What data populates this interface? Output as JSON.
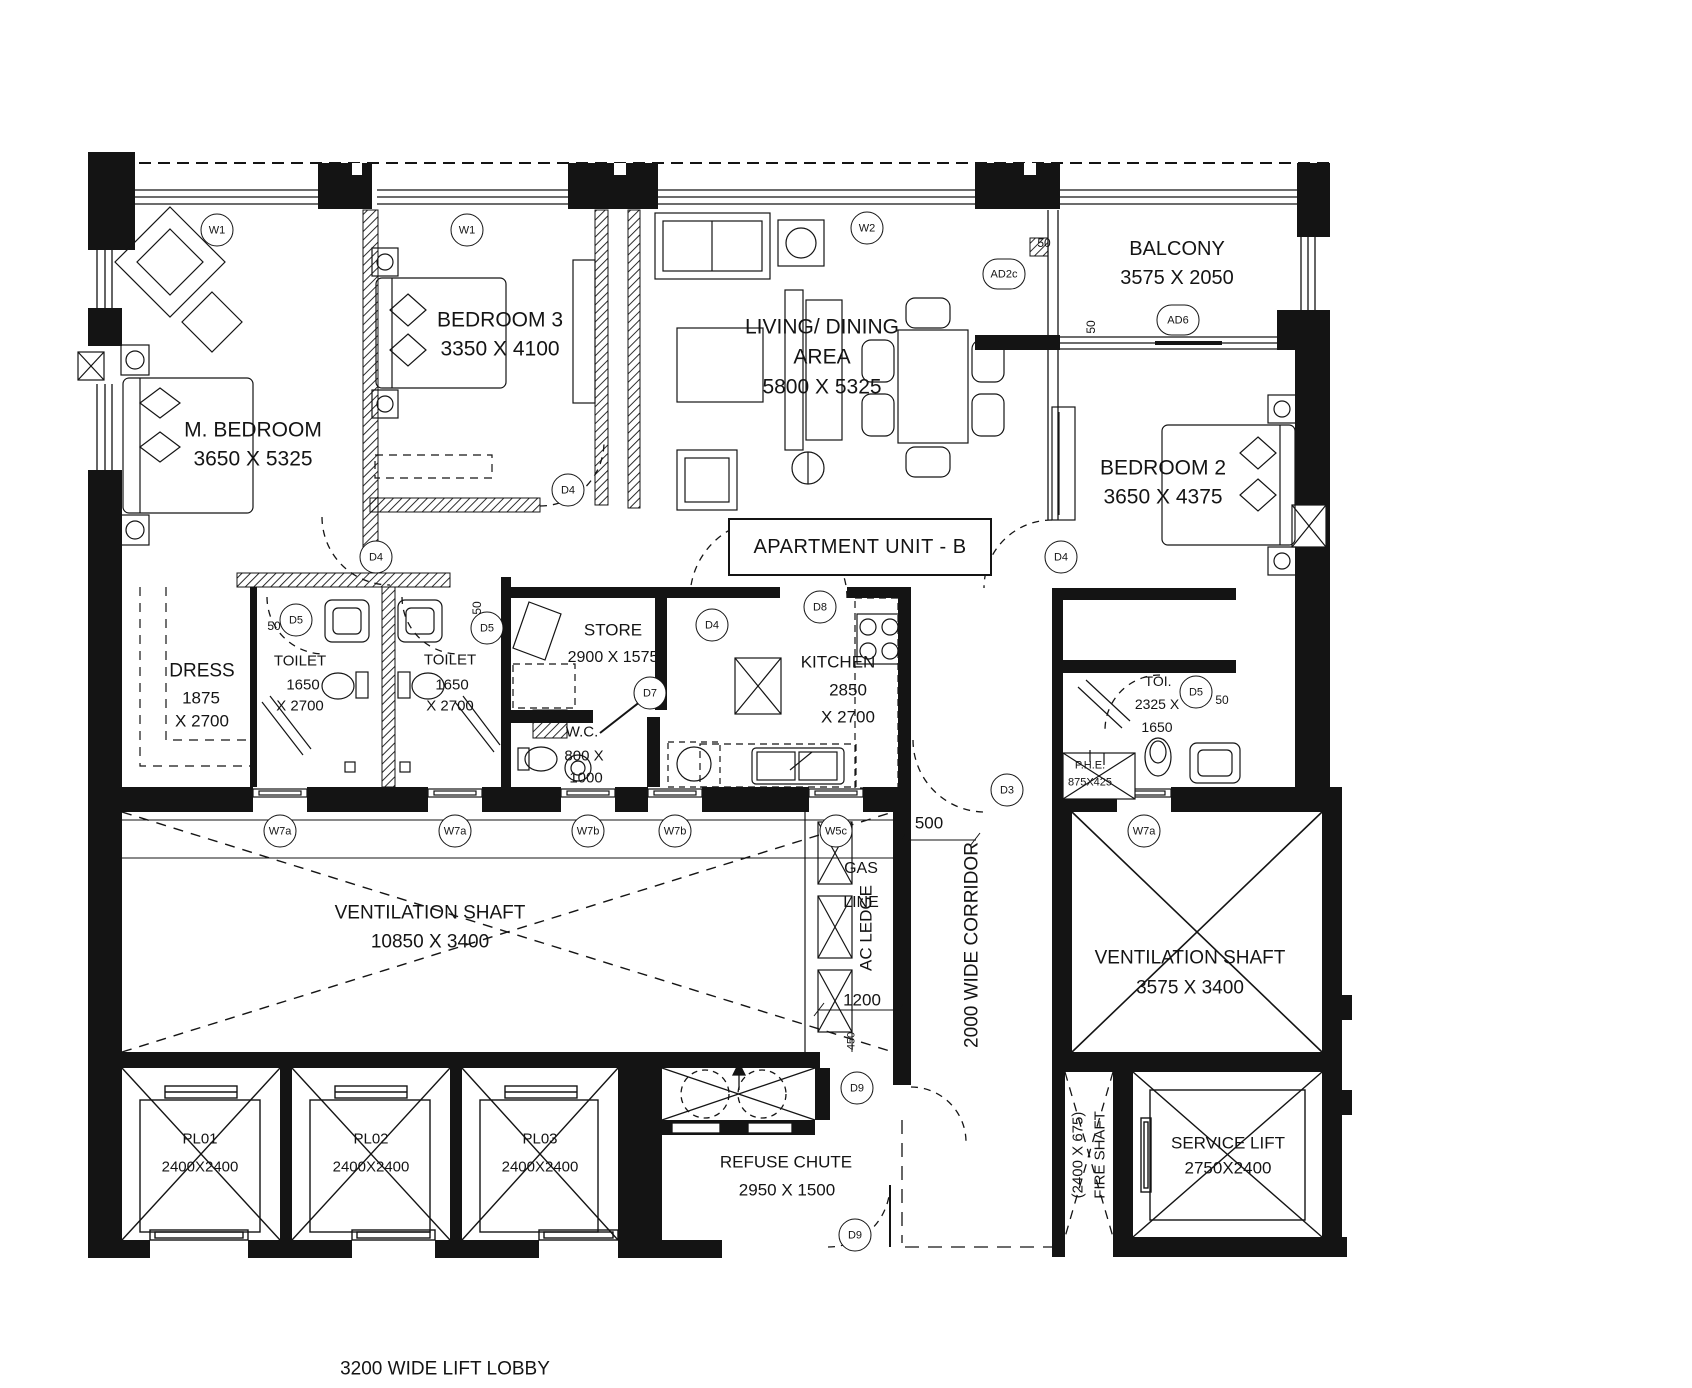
{
  "title": {
    "label": "APARTMENT UNIT - B"
  },
  "rooms": {
    "m_bedroom": {
      "name": "M. BEDROOM",
      "dims": "3650 X 5325"
    },
    "bedroom3": {
      "name": "BEDROOM 3",
      "dims": "3350 X 4100"
    },
    "living": {
      "name": "LIVING/ DINING",
      "name2": "AREA",
      "dims": "5800 X 5325"
    },
    "balcony": {
      "name": "BALCONY",
      "dims": "3575 X 2050"
    },
    "bedroom2": {
      "name": "BEDROOM 2",
      "dims": "3650 X 4375"
    },
    "dress": {
      "name": "DRESS",
      "dims1": "1875",
      "dims2": "X 2700"
    },
    "toilet1": {
      "name": "TOILET",
      "dims1": "1650",
      "dims2": "X 2700"
    },
    "toilet2": {
      "name": "TOILET",
      "dims1": "1650",
      "dims2": "X 2700"
    },
    "store": {
      "name": "STORE",
      "dims": "2900 X 1575"
    },
    "wc": {
      "name": "W.C.",
      "dims1": "800 X",
      "dims2": "1000"
    },
    "kitchen": {
      "name": "KITCHEN",
      "dims1": "2850",
      "dims2": "X 2700"
    },
    "toi": {
      "name": "TOI.",
      "dims1": "2325 X",
      "dims2": "1650"
    },
    "phe": {
      "name": "P.H.E.",
      "dims": "875X425"
    },
    "vent_left": {
      "name": "VENTILATION SHAFT",
      "dims": "10850 X 3400"
    },
    "vent_right": {
      "name": "VENTILATION SHAFT",
      "dims": "3575 X 3400"
    },
    "corridor": {
      "name": "2000 WIDE CORRIDOR"
    },
    "ac_ledge": {
      "name": "AC LEDGE"
    },
    "gas_line": {
      "l1": "GAS",
      "l2": "LINE"
    },
    "fire_shaft": {
      "name": "FIRE SHAFT",
      "dims": "(2400 X 675)"
    },
    "service_lift": {
      "name": "SERVICE LIFT",
      "dims": "2750X2400"
    },
    "refuse": {
      "name": "REFUSE CHUTE",
      "dims": "2950 X 1500"
    },
    "pl01": {
      "name": "PL01",
      "dims": "2400X2400"
    },
    "pl02": {
      "name": "PL02",
      "dims": "2400X2400"
    },
    "pl03": {
      "name": "PL03",
      "dims": "2400X2400"
    },
    "lobby": {
      "name": "3200 WIDE LIFT LOBBY"
    }
  },
  "tags": [
    {
      "label": "W1"
    },
    {
      "label": "W1"
    },
    {
      "label": "W2"
    },
    {
      "label": "AD2c"
    },
    {
      "label": "AD6"
    },
    {
      "label": "D4"
    },
    {
      "label": "D4"
    },
    {
      "label": "D4"
    },
    {
      "label": "D4"
    },
    {
      "label": "D5"
    },
    {
      "label": "D5"
    },
    {
      "label": "D5"
    },
    {
      "label": "D7"
    },
    {
      "label": "D8"
    },
    {
      "label": "D3"
    },
    {
      "label": "D9"
    },
    {
      "label": "D9"
    },
    {
      "label": "W7a"
    },
    {
      "label": "W7a"
    },
    {
      "label": "W7b"
    },
    {
      "label": "W7b"
    },
    {
      "label": "W5c"
    },
    {
      "label": "W7a"
    }
  ],
  "dims": {
    "d50": "50",
    "d500": "500",
    "d1200": "1200",
    "d450": "450"
  }
}
